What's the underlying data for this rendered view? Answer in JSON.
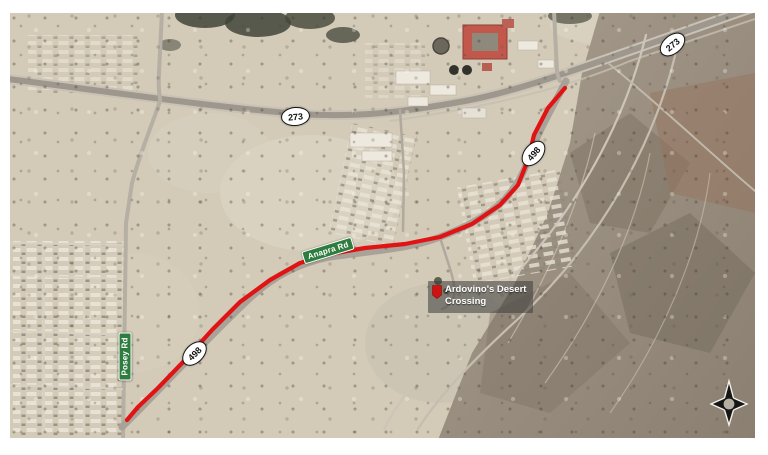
{
  "map": {
    "shields": [
      {
        "id": "sr-273-west",
        "text": "273"
      },
      {
        "id": "sr-273-east",
        "text": "273"
      },
      {
        "id": "sr-498-north",
        "text": "498"
      },
      {
        "id": "sr-498-south",
        "text": "498"
      }
    ],
    "street_signs": [
      {
        "id": "anapra-rd",
        "text": "Anapra Rd"
      },
      {
        "id": "posey-rd",
        "text": "Posey Rd"
      }
    ],
    "poi": {
      "line1": "Ardovino's Desert",
      "line2": "Crossing"
    },
    "colors": {
      "route_red": "#e01414",
      "street_sign_green": "#2e7d3f",
      "shield_fill": "#ffffff",
      "shield_border": "#151515"
    },
    "icons": {
      "poi_marker": "red-location-marker",
      "compass": "compass-rose"
    }
  }
}
